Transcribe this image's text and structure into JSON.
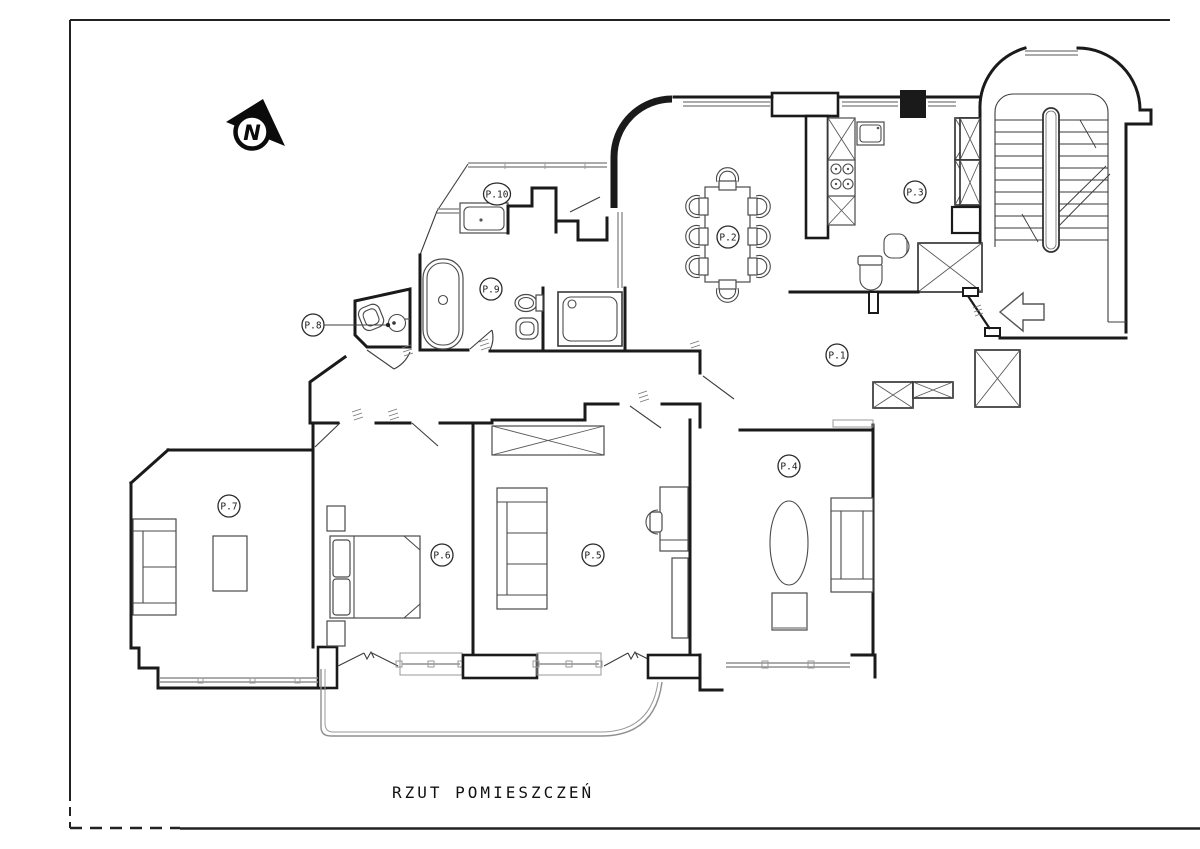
{
  "drawing": {
    "title": "RZUT POMIESZCZEŃ",
    "compass": {
      "label": "N"
    },
    "rooms": [
      {
        "id": "p1",
        "label": "P.1"
      },
      {
        "id": "p2",
        "label": "P.2"
      },
      {
        "id": "p3",
        "label": "P.3"
      },
      {
        "id": "p4",
        "label": "P.4"
      },
      {
        "id": "p5",
        "label": "P.5"
      },
      {
        "id": "p6",
        "label": "P.6"
      },
      {
        "id": "p7",
        "label": "P.7"
      },
      {
        "id": "p8",
        "label": "P.8"
      },
      {
        "id": "p9",
        "label": "P.9"
      },
      {
        "id": "p10",
        "label": "P.10"
      }
    ]
  }
}
